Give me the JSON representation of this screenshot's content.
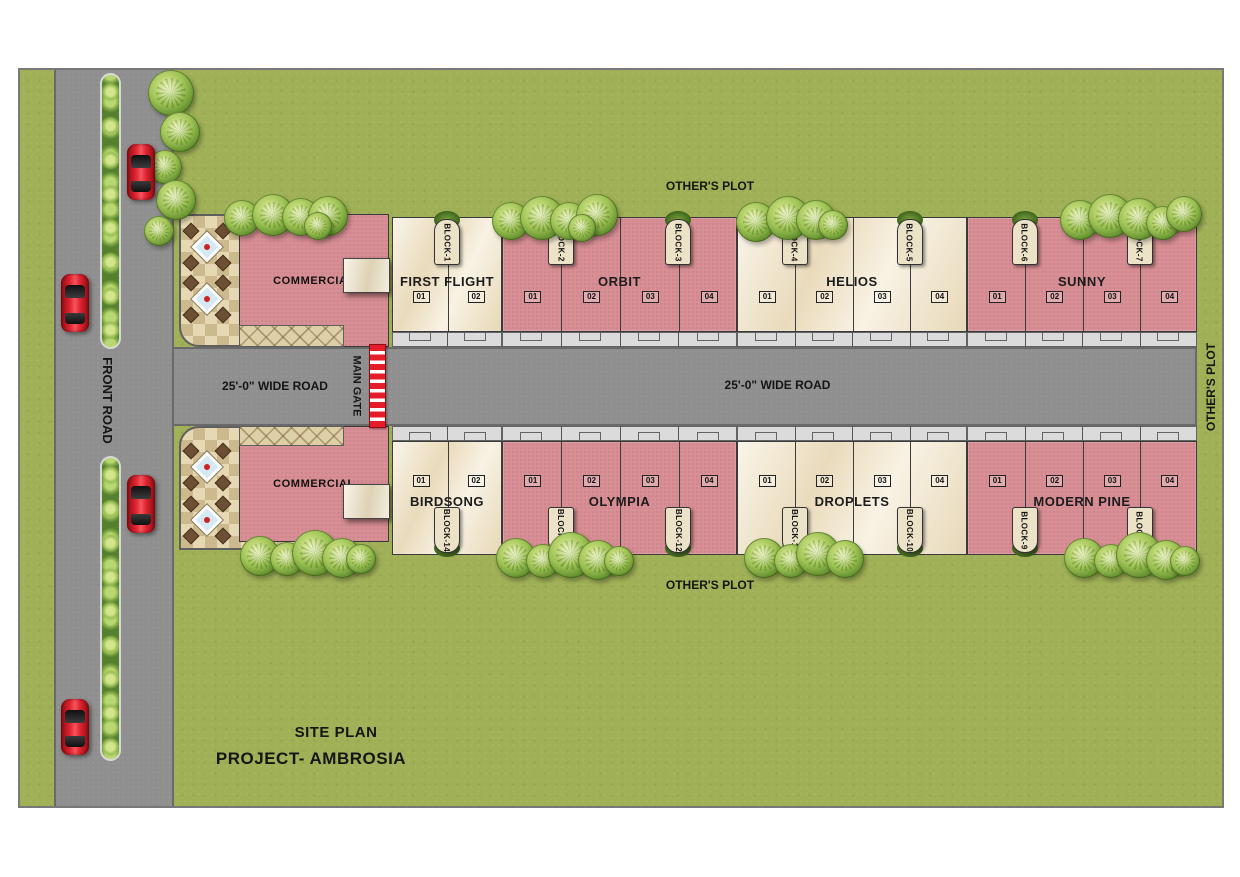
{
  "map": {
    "site_plan_title": "SITE PLAN",
    "project_title": "PROJECT- AMBROSIA",
    "front_road_label": "FRONT ROAD",
    "main_gate_label": "MAIN GATE",
    "wide_road_label_left": "25'-0\" WIDE ROAD",
    "wide_road_label_center": "25'-0\" WIDE ROAD",
    "others_plot_top": "OTHER'S PLOT",
    "others_plot_bottom": "OTHER'S PLOT",
    "others_plot_right": "OTHER'S PLOT",
    "commercial_top_label": "COMMERCIAL",
    "commercial_bottom_label": "COMMERCIAL"
  },
  "rows": {
    "top": [
      {
        "name": "FIRST FLIGHT",
        "style": "cream",
        "units": [
          "01",
          "02"
        ],
        "tags": [
          "BLOCK-1"
        ]
      },
      {
        "name": "ORBIT",
        "style": "pink",
        "units": [
          "01",
          "02",
          "03",
          "04"
        ],
        "tags": [
          "BLOCK-2",
          "BLOCK-3"
        ]
      },
      {
        "name": "HELIOS",
        "style": "cream",
        "units": [
          "01",
          "02",
          "03",
          "04"
        ],
        "tags": [
          "BLOCK-4",
          "BLOCK-5"
        ]
      },
      {
        "name": "SUNNY",
        "style": "pink",
        "units": [
          "01",
          "02",
          "03",
          "04"
        ],
        "tags": [
          "BLOCK-6",
          "BLOCK-7"
        ]
      }
    ],
    "bottom": [
      {
        "name": "BIRDSONG",
        "style": "cream",
        "units": [
          "01",
          "02"
        ],
        "tags": [
          "BLOCK-14"
        ]
      },
      {
        "name": "OLYMPIA",
        "style": "pink",
        "units": [
          "01",
          "02",
          "03",
          "04"
        ],
        "tags": [
          "BLOCK-13",
          "BLOCK-12"
        ]
      },
      {
        "name": "DROPLETS",
        "style": "cream",
        "units": [
          "01",
          "02",
          "03",
          "04"
        ],
        "tags": [
          "BLOCK-11",
          "BLOCK-10"
        ]
      },
      {
        "name": "MODERN PINE",
        "style": "pink",
        "units": [
          "01",
          "02",
          "03",
          "04"
        ],
        "tags": [
          "BLOCK-9",
          "BLOCK-8"
        ]
      }
    ]
  },
  "colors": {
    "grass": "#9fb056",
    "road": "#8f8f8f",
    "cream_block": "#f3e8ce",
    "pink_block": "#d78e94",
    "sidewalk": "#dbdbdb",
    "gate_red": "#e51c2a",
    "car_red": "#e02430",
    "patio_tan": "#e6d8b2"
  }
}
